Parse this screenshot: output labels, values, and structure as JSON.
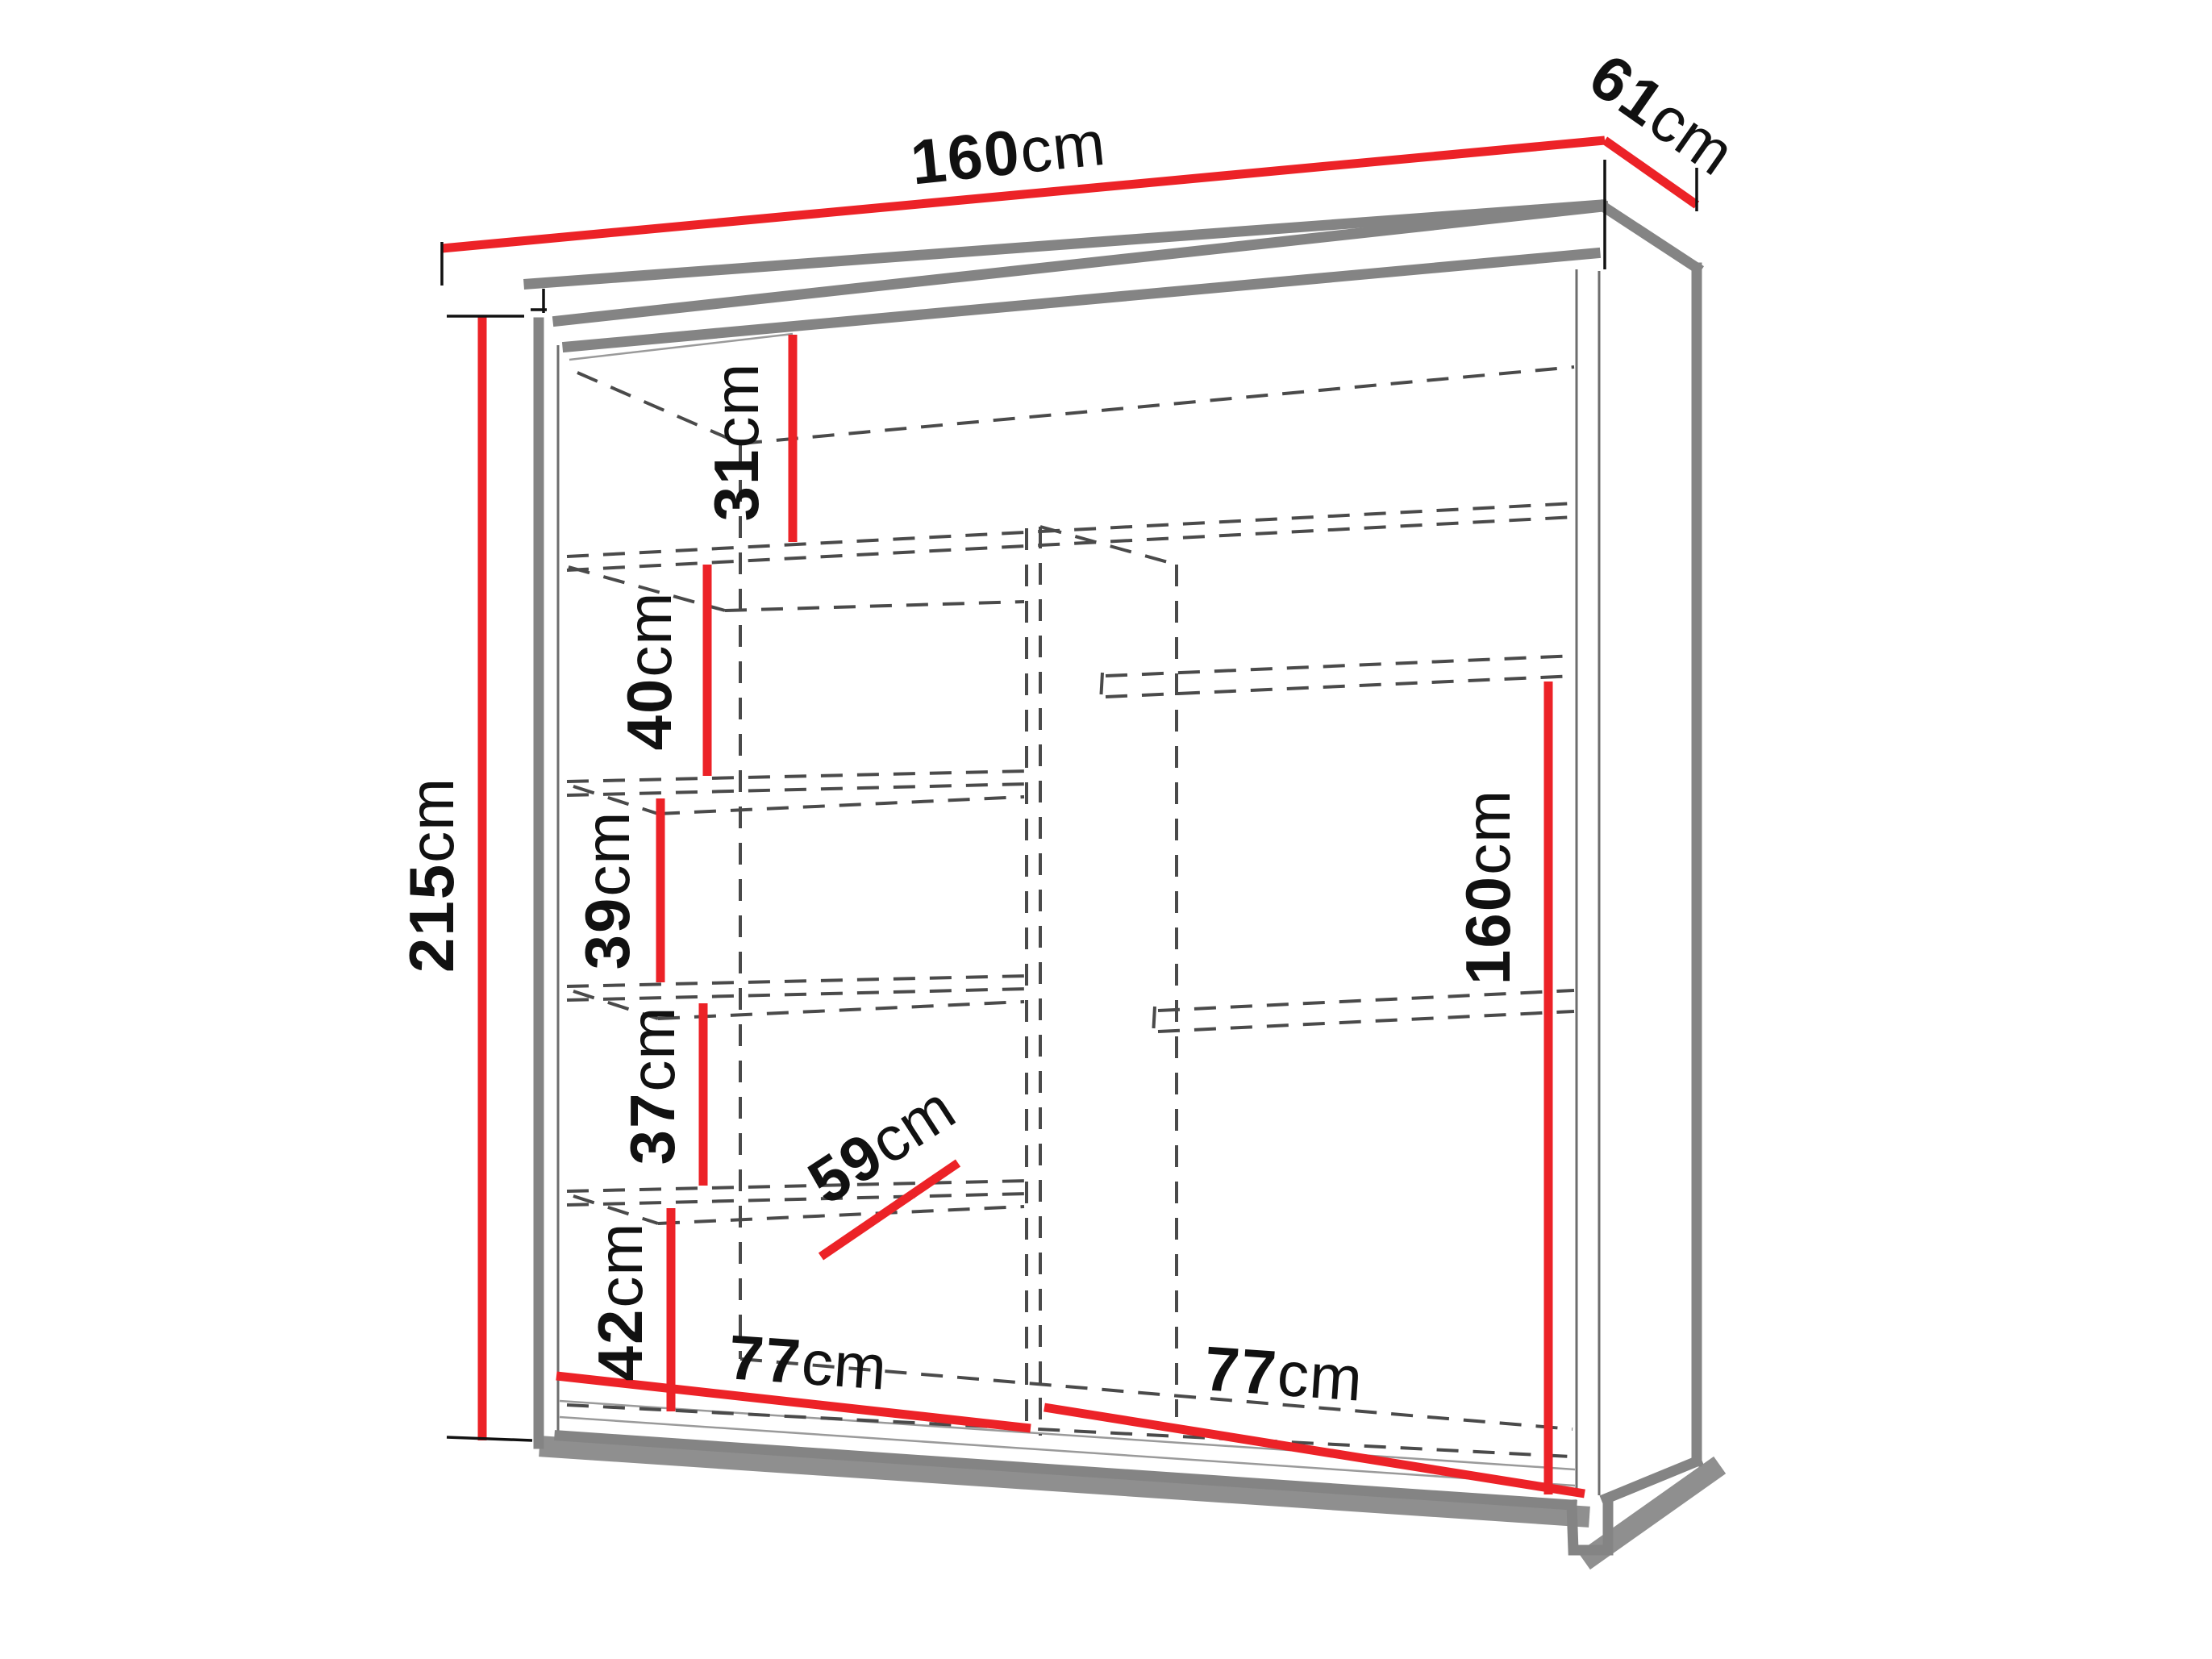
{
  "diagram": {
    "type": "furniture-dimension-diagram",
    "subject": "sliding-door wardrobe with left shelf column and right hanging section",
    "background_color": "#ffffff",
    "colors": {
      "dimension_line": "#ec2227",
      "outline": "#848484",
      "hidden_edge": "#4a4a4a",
      "label_text": "#111111"
    },
    "dimensions": {
      "total_width": {
        "value": "160",
        "unit": "cm"
      },
      "total_depth": {
        "value": "61",
        "unit": "cm"
      },
      "total_height": {
        "value": "215",
        "unit": "cm"
      },
      "top_compartment": {
        "value": "31",
        "unit": "cm"
      },
      "shelf_space_1": {
        "value": "40",
        "unit": "cm"
      },
      "shelf_space_2": {
        "value": "39",
        "unit": "cm"
      },
      "shelf_space_3": {
        "value": "37",
        "unit": "cm"
      },
      "bottom_space": {
        "value": "42",
        "unit": "cm"
      },
      "shelf_depth": {
        "value": "59",
        "unit": "cm"
      },
      "left_width": {
        "value": "77",
        "unit": "cm"
      },
      "right_width": {
        "value": "77",
        "unit": "cm"
      },
      "hanging_height": {
        "value": "160",
        "unit": "cm"
      }
    }
  }
}
